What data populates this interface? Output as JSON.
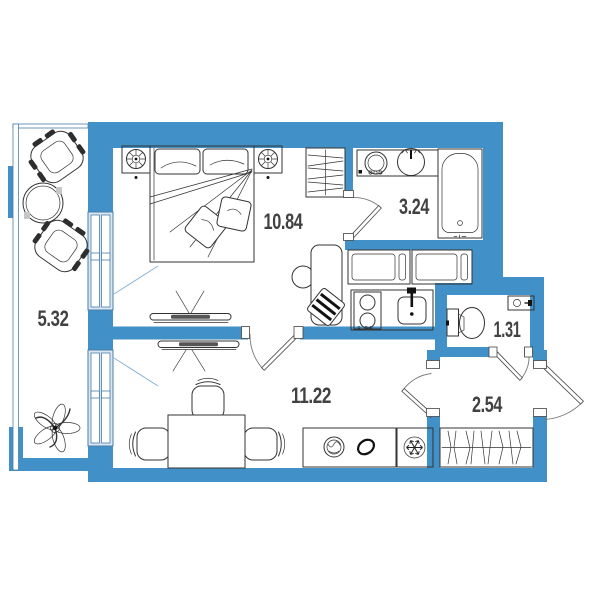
{
  "plan": {
    "type": "apartment-floor-plan",
    "colors": {
      "wall_blue": "#4190C7",
      "window_light_blue": "#D9E7F4",
      "window_frame_blue": "#4A7EA8",
      "outline_dark": "#333333",
      "label_gray": "#414141",
      "background": "#FFFFFF"
    },
    "rooms": {
      "balcony": {
        "area": "5.32",
        "furniture": [
          "lounge-chair",
          "lounge-chair",
          "round-table",
          "plant"
        ]
      },
      "bedroom": {
        "area": "10.84",
        "furniture": [
          "double-bed",
          "nightstand-with-lamp",
          "nightstand-with-lamp",
          "tv-on-partition",
          "wardrobe-with-hangers",
          "desk",
          "desk-chair",
          "striped-cushion"
        ]
      },
      "bathroom": {
        "area": "3.24",
        "furniture": [
          "washing-machine",
          "washbasin",
          "bathtub"
        ]
      },
      "living_kitchen": {
        "area": "11.22",
        "furniture": [
          "tv-on-partition",
          "dining-table",
          "chair",
          "chair",
          "chair",
          "kitchen-upper-cabinets",
          "stove",
          "kitchen-sink",
          "counter-washer",
          "decor-bowl",
          "refrigerator-snowflake"
        ]
      },
      "wc": {
        "area": "1.31",
        "furniture": [
          "toilet",
          "hand-basin"
        ]
      },
      "hallway": {
        "area": "2.54",
        "furniture": [
          "built-in-wardrobe"
        ]
      }
    }
  }
}
